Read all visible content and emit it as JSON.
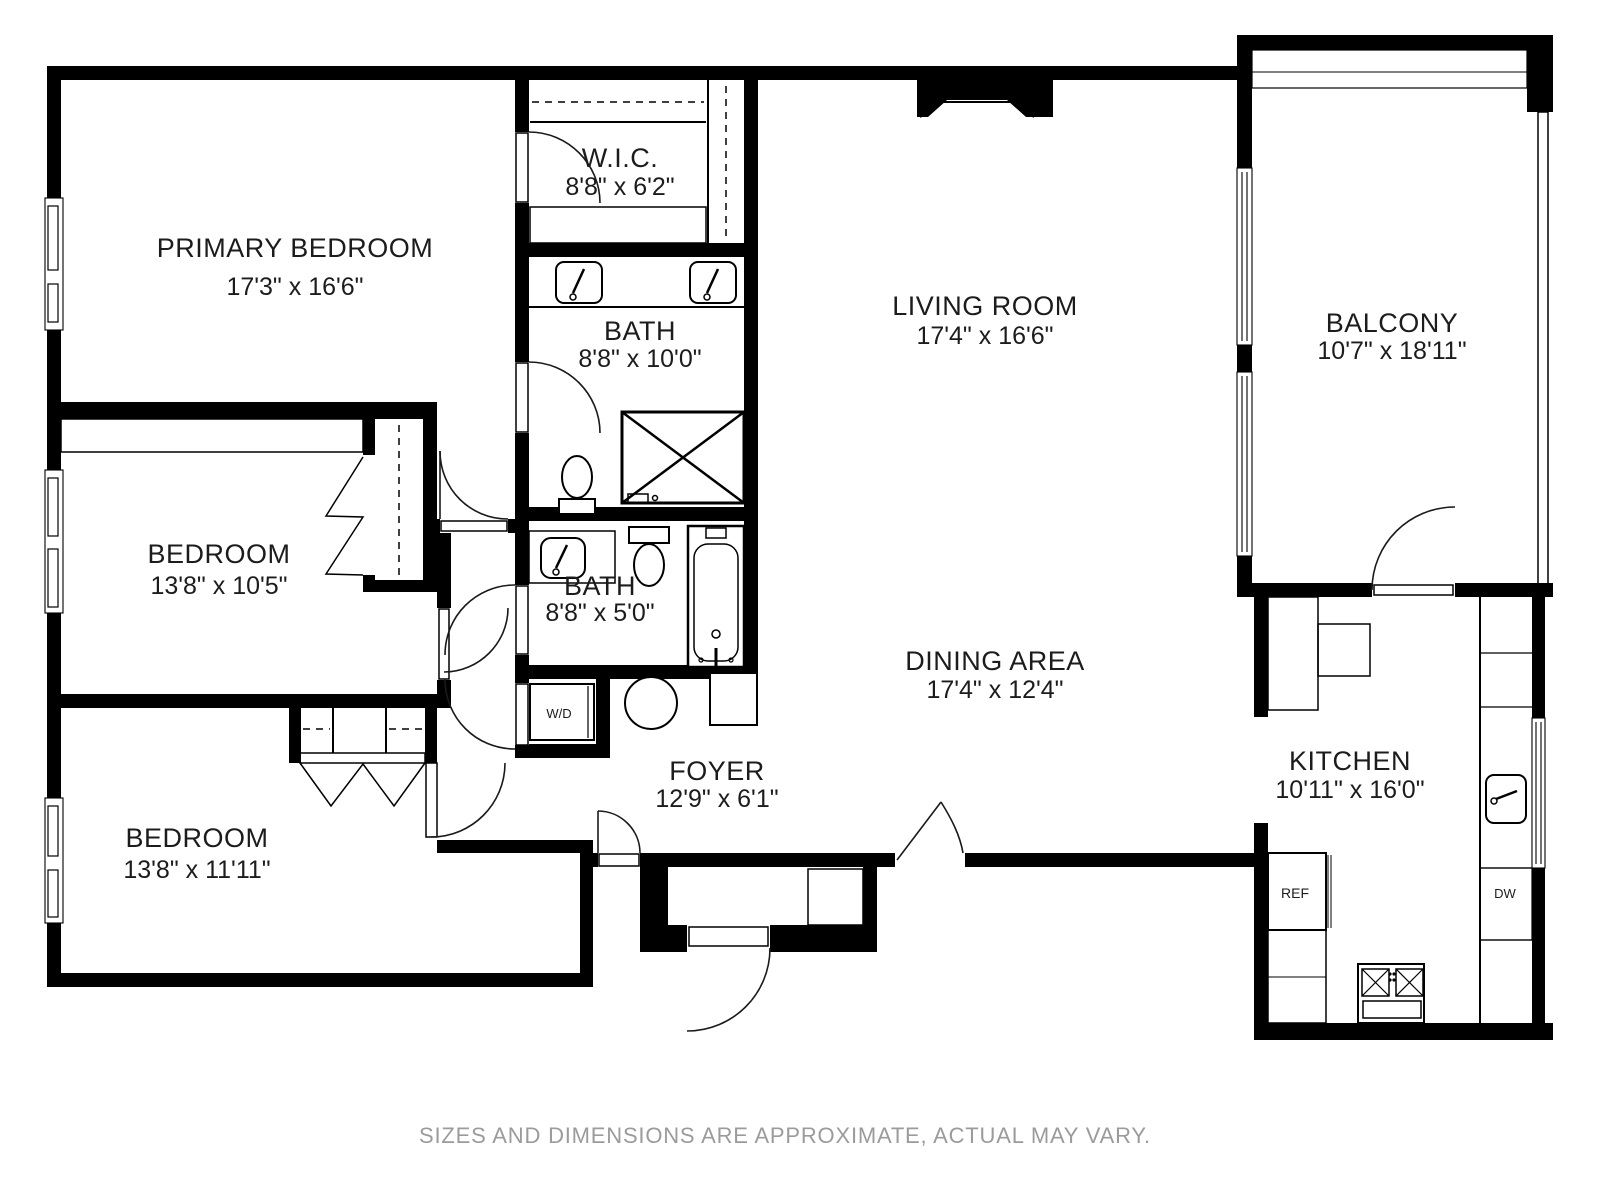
{
  "floorplan": {
    "rooms": [
      {
        "name": "PRIMARY BEDROOM",
        "dims": "17'3\" x 16'6\""
      },
      {
        "name": "W.I.C.",
        "dims": "8'8\" x 6'2\""
      },
      {
        "name": "BATH",
        "dims": "8'8\" x 10'0\""
      },
      {
        "name": "LIVING ROOM",
        "dims": "17'4\" x 16'6\""
      },
      {
        "name": "BALCONY",
        "dims": "10'7\" x 18'11\""
      },
      {
        "name": "BEDROOM",
        "dims": "13'8\" x 10'5\""
      },
      {
        "name": "BATH",
        "dims": "8'8\" x 5'0\""
      },
      {
        "name": "DINING AREA",
        "dims": "17'4\" x 12'4\""
      },
      {
        "name": "BEDROOM",
        "dims": "13'8\" x 11'11\""
      },
      {
        "name": "FOYER",
        "dims": "12'9\" x 6'1\""
      },
      {
        "name": "KITCHEN",
        "dims": "10'11\" x 16'0\""
      }
    ],
    "appliances": {
      "washer_dryer": "W/D",
      "refrigerator": "REF",
      "dishwasher": "DW"
    },
    "disclaimer": "SIZES AND DIMENSIONS ARE APPROXIMATE, ACTUAL MAY VARY.",
    "colors": {
      "wall": "#000000",
      "background": "#ffffff",
      "disclaimer_text": "#9b9b9b"
    }
  }
}
